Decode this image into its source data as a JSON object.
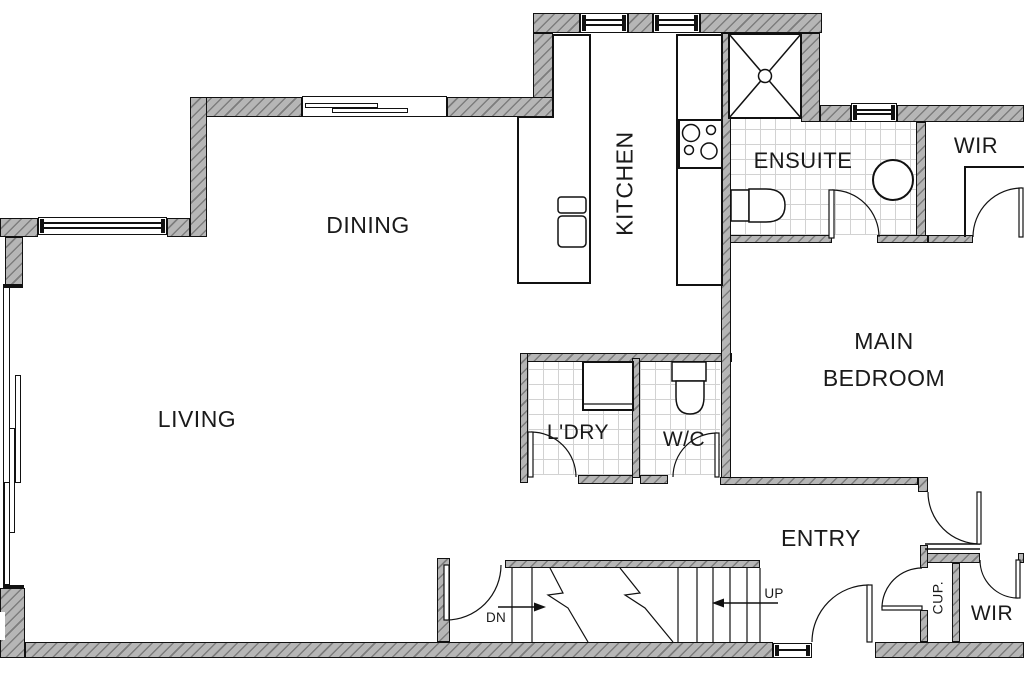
{
  "title": "Apartment floor plan",
  "rooms": {
    "dining": "DINING",
    "living": "LIVING",
    "kitchen": "KITCHEN",
    "ensuite": "ENSUITE",
    "wir_top": "WIR",
    "main_bedroom_line1": "MAIN",
    "main_bedroom_line2": "BEDROOM",
    "laundry": "L'DRY",
    "wc": "W/C",
    "entry": "ENTRY",
    "cupboard": "CUP.",
    "wir_bottom": "WIR"
  },
  "stairs": {
    "up": "UP",
    "dn": "DN"
  },
  "colors": {
    "background": "#ffffff",
    "wall_fill": "#b6b6b6",
    "wall_hatch_line": "#7d7d7d",
    "outline": "#111111",
    "tile_line": "#d2d2d2"
  }
}
